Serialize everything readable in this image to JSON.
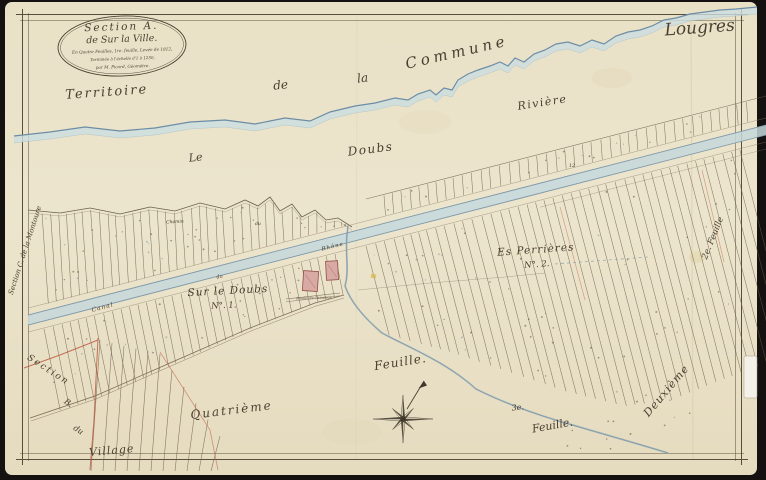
{
  "corner": {
    "commune_name": "Lougres"
  },
  "cartouche": {
    "line1": "Section A.",
    "line2": "de Sur la Ville.",
    "line3": "En Quatre Feuilles, 1re. feuille, Levée de 1812,",
    "line4": "Terminée à l'échelle d'1 à 1250,",
    "line5": "par M. Picard, Géomètre."
  },
  "territory": {
    "territoire": "Territoire",
    "de": "de",
    "la": "la",
    "commune": "Commune",
    "riviere": "Rivière"
  },
  "river": {
    "le": "Le",
    "doubs": "Doubs"
  },
  "canal": {
    "canal": "Canal",
    "du": "du",
    "rhone": "Rhône"
  },
  "roads": {
    "chemin": "Chemin",
    "du": "du"
  },
  "places": {
    "lieu1_name": "Sur le Doubs",
    "lieu1_no": "N°. 1.",
    "lieu2_name": "Es Perrières",
    "lieu2_no": "N°. 2.",
    "mill": "Moulin de Chaudron",
    "parcel_number": "12"
  },
  "sheets": {
    "feuille_center": "Feuille.",
    "feuille3_num": "3e.",
    "feuille3_word": "Feuille.",
    "quatrieme": "Quatrième",
    "deuxieme": "Deuxième",
    "feuille2_right": "2e. Feuille"
  },
  "sections": {
    "left": "Section C. de la Montoure",
    "bottom_section": "Section",
    "bottom_b": "B.",
    "bottom_du": "du",
    "village": "Village"
  },
  "colors": {
    "paper": "#ebe3c9",
    "ink": "#4a3f30",
    "river_line": "#6d8da4",
    "river_fill": "#cbdde1",
    "canal_fill": "#c6d8dc",
    "building_pink": "#d9a9a3",
    "boundary_red": "#bf5a40"
  }
}
